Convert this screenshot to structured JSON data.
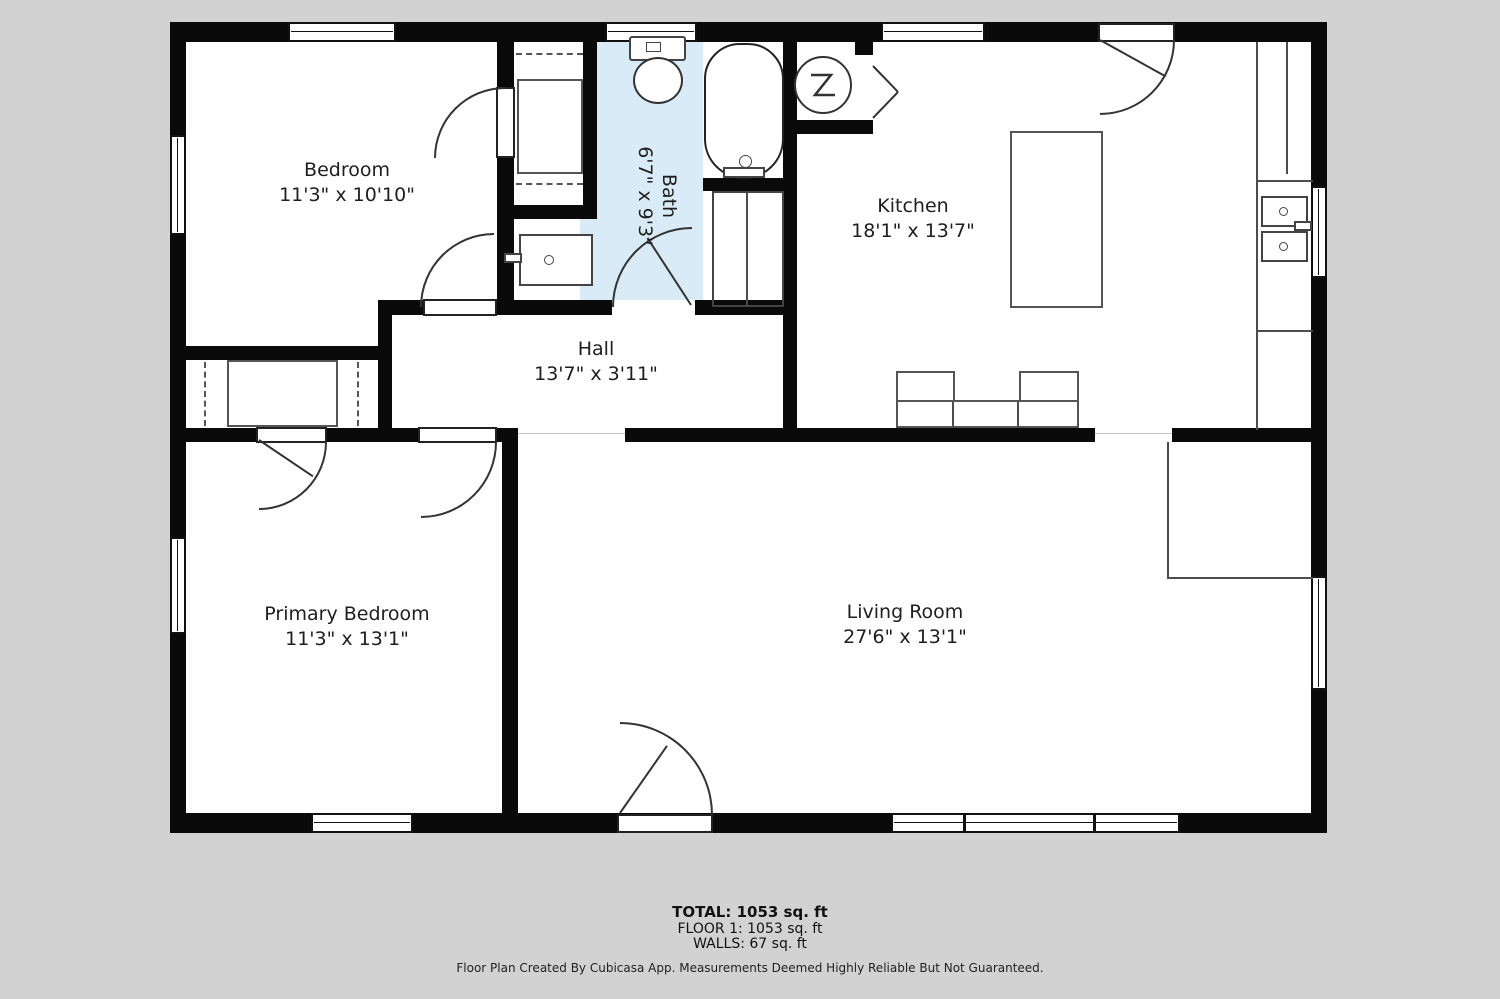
{
  "plan": {
    "rooms": {
      "bedroom": {
        "name": "Bedroom",
        "dims": "11'3\" x 10'10\""
      },
      "bath": {
        "name": "Bath",
        "dims": "6'7\" x 9'3\""
      },
      "kitchen": {
        "name": "Kitchen",
        "dims": "18'1\" x 13'7\""
      },
      "hall": {
        "name": "Hall",
        "dims": "13'7\" x 3'11\""
      },
      "primary_bedroom": {
        "name": "Primary Bedroom",
        "dims": "11'3\" x 13'1\""
      },
      "living_room": {
        "name": "Living Room",
        "dims": "27'6\" x 13'1\""
      }
    },
    "colors": {
      "background": "#d2d2d2",
      "wall": "#0a0a0a",
      "bath_fill": "#d9ebf7",
      "fixture_line": "#4d4d4d"
    }
  },
  "summary": {
    "total": "TOTAL: 1053 sq. ft",
    "floor": "FLOOR 1: 1053 sq. ft",
    "walls": "WALLS: 67 sq. ft"
  },
  "footer": {
    "disclaimer": "Floor Plan Created By Cubicasa App. Measurements Deemed Highly Reliable But Not Guaranteed."
  }
}
